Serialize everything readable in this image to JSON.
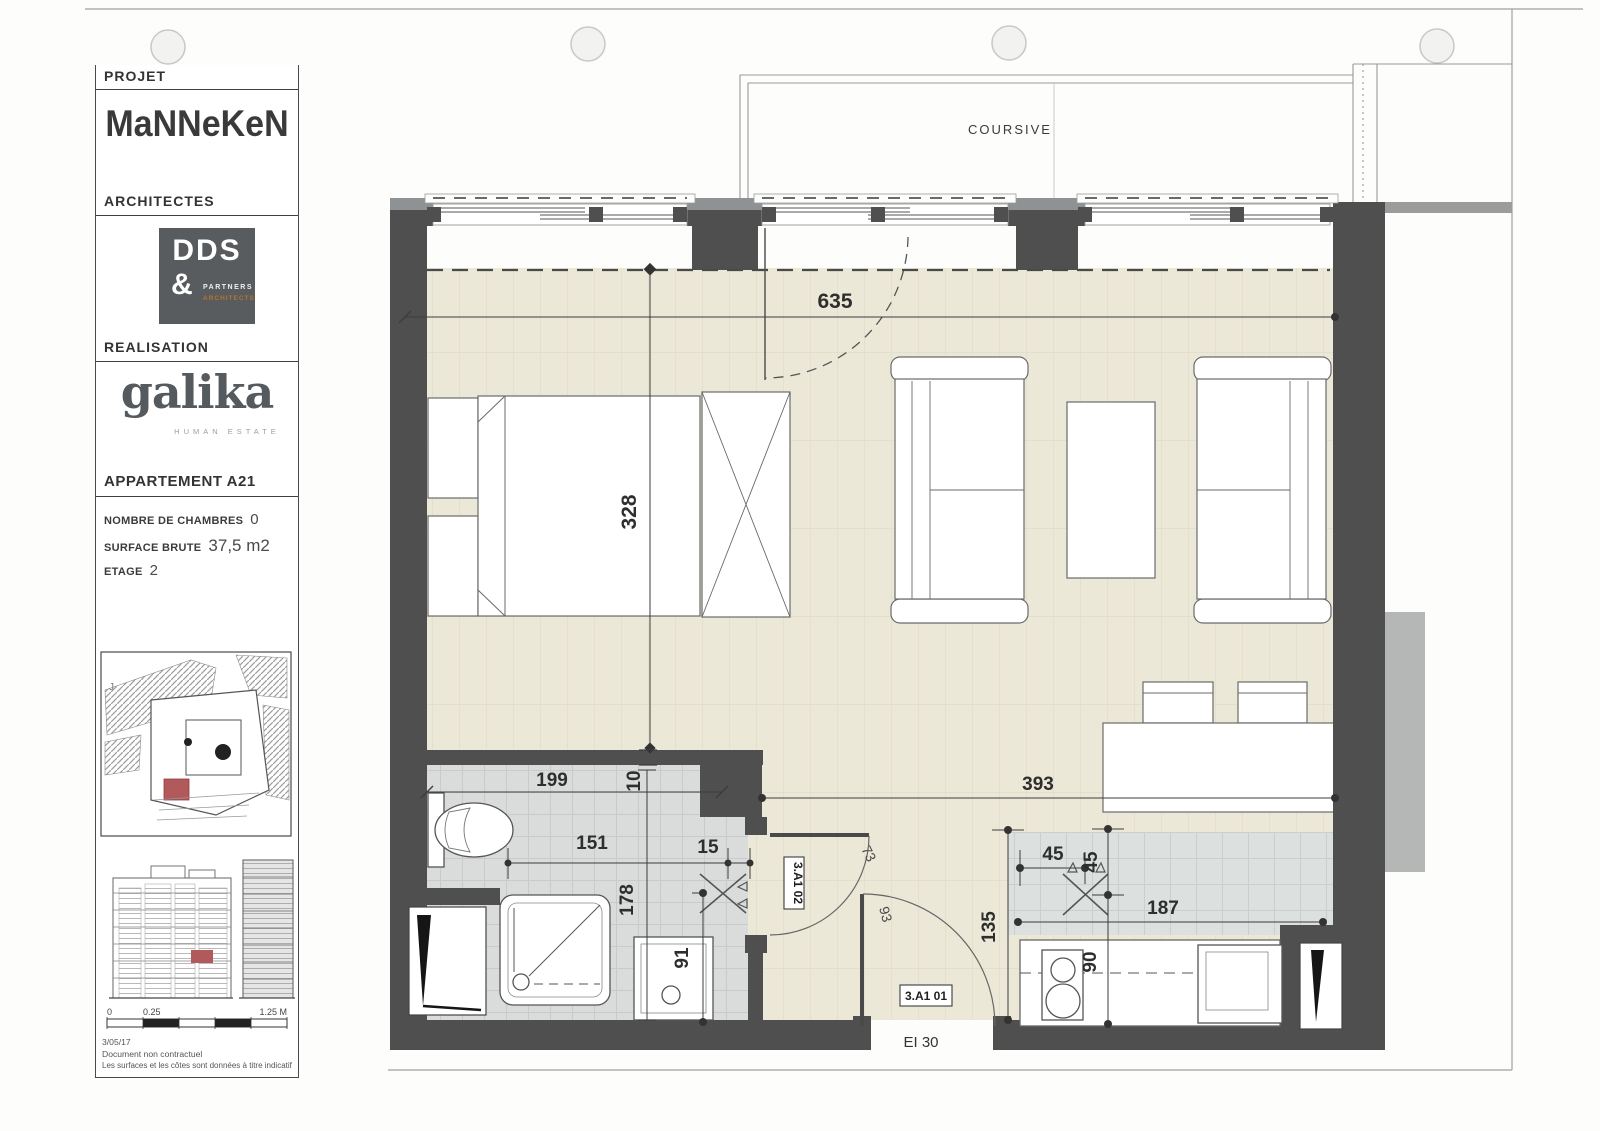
{
  "sidebar": {
    "projet_label": "PROJET",
    "brand": "MaNNeKeN",
    "architectes_label": "ARCHITECTES",
    "architect_logo": {
      "name": "DDS",
      "amp": "&",
      "sub1": "PARTNERS",
      "sub2": "ARCHITECTS"
    },
    "realisation_label": "REALISATION",
    "developer_logo": {
      "name": "galika",
      "tagline": "HUMAN ESTATE"
    },
    "apartment_title": "APPARTEMENT A21",
    "fields": [
      {
        "label": "NOMBRE DE CHAMBRES",
        "value": "0"
      },
      {
        "label": "SURFACE BRUTE",
        "value": "37,5 m2"
      },
      {
        "label": "ETAGE",
        "value": "2"
      }
    ],
    "map_mark": "J",
    "scale_bar": {
      "start": "0",
      "mid": "0.25",
      "end": "1.25 M"
    },
    "date": "3/05/17",
    "disclaimer_line1": "Document non contractuel",
    "disclaimer_line2": "Les surfaces et les côtes sont données à titre indicatif"
  },
  "plan": {
    "coursive_label": "COURSIVE",
    "door_rating": "EI 30",
    "room_codes": {
      "bathroom": "3.A1 02",
      "entrance": "3.A1 01"
    },
    "dimensions": {
      "room_width": "635",
      "room_depth": "328",
      "bath_width": "199",
      "wall_thickness": "10",
      "bath_inner": "151",
      "stub": "15",
      "bath_depth": "178",
      "basin": "91",
      "living_width": "393",
      "sink_offset_x": "45",
      "sink_offset_y": "45",
      "kitchen_depth": "135",
      "counter_length": "187",
      "counter_depth": "90",
      "bath_door": "73",
      "entry_door": "93"
    }
  },
  "colors": {
    "wall": "#4f4f4f",
    "floor": "#ebe8d7",
    "tile_bath": "#d9dcda",
    "tile_kitchen": "#dce1e0",
    "accent_red": "#b2595c",
    "logo_orange": "#b5722e"
  }
}
